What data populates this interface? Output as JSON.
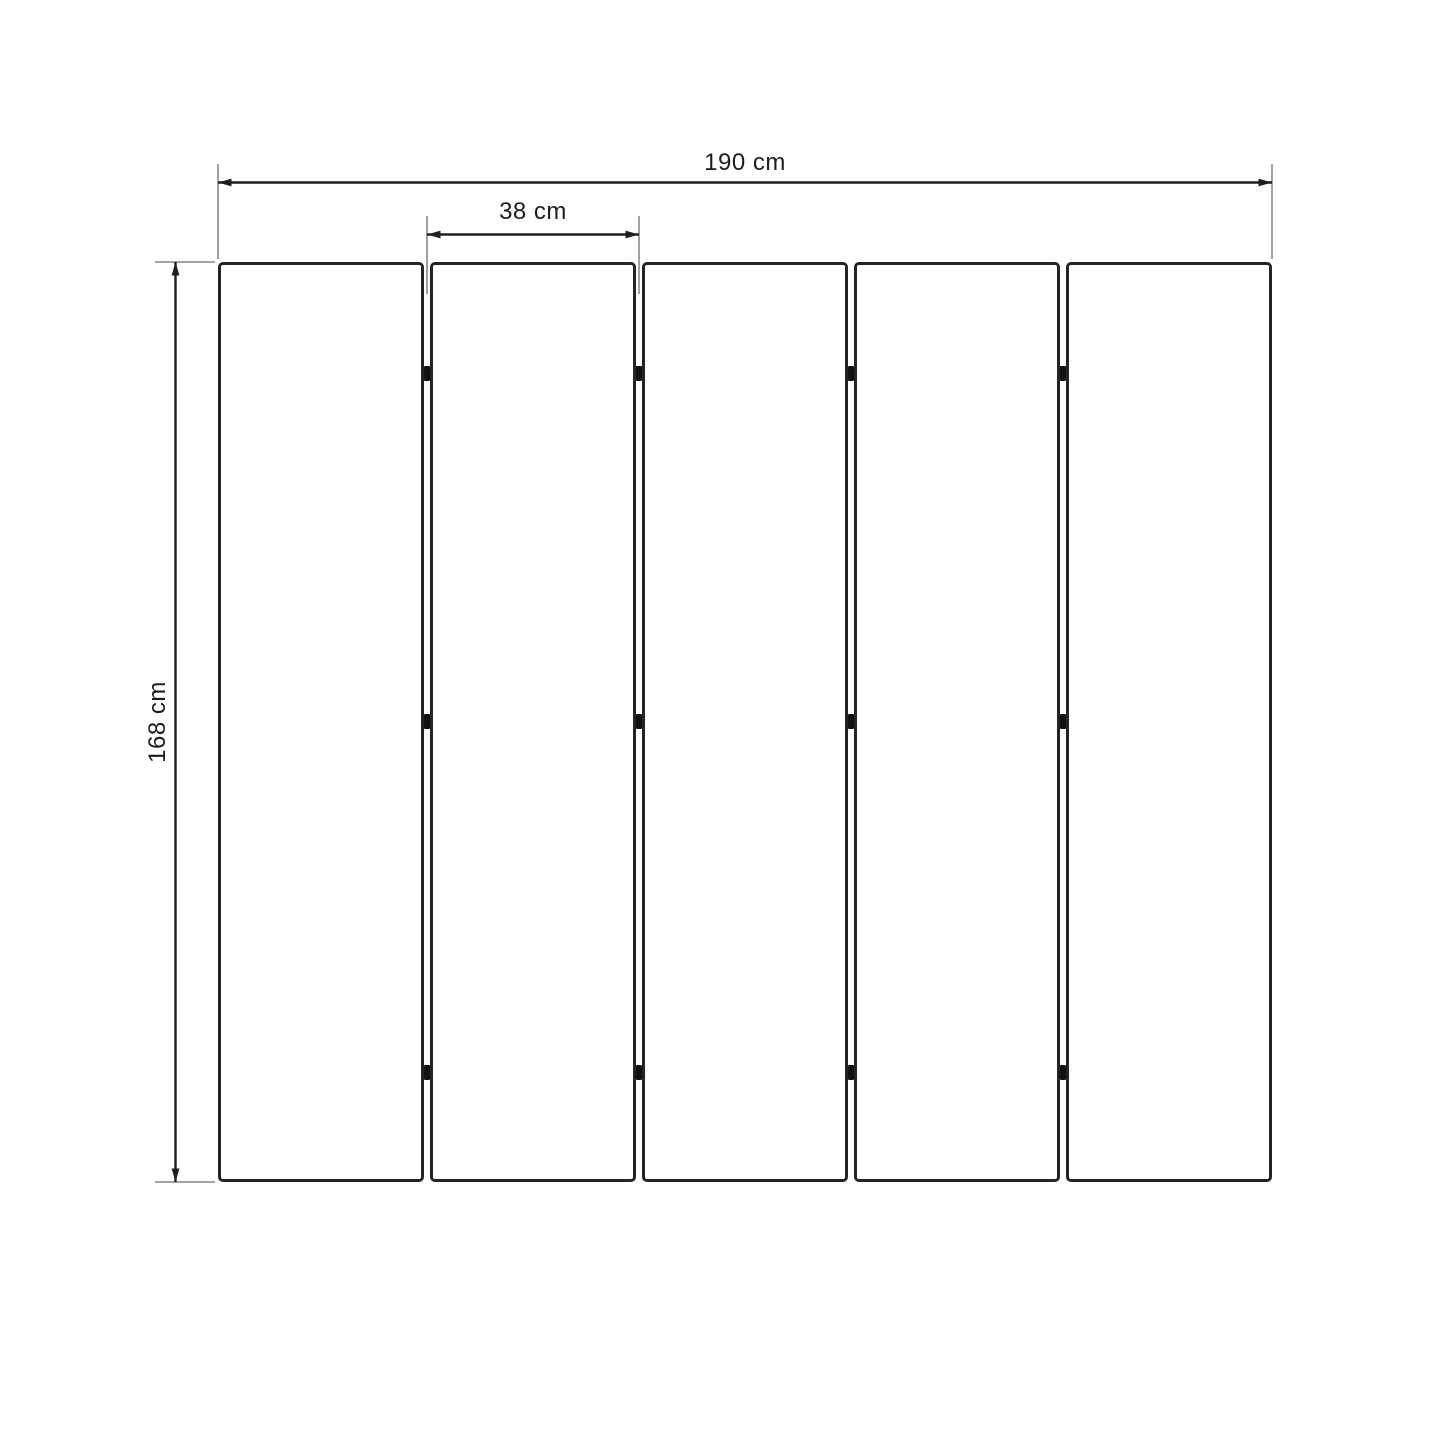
{
  "diagram": {
    "type": "dimension-drawing",
    "subject": "five-panel-folding-screen-front-view",
    "labels": {
      "total_width": "190 cm",
      "panel_width": "38 cm",
      "height": "168 cm"
    },
    "panels": {
      "count": 5,
      "hinge_gaps": 4,
      "hinges_per_gap": 3
    },
    "colors": {
      "background": "#ffffff",
      "panel_border": "#242424",
      "dimension_line": "#1f1f1f",
      "extension_line": "#6e6e6e",
      "hinge": "#111111",
      "text": "#1d1d1d"
    }
  }
}
